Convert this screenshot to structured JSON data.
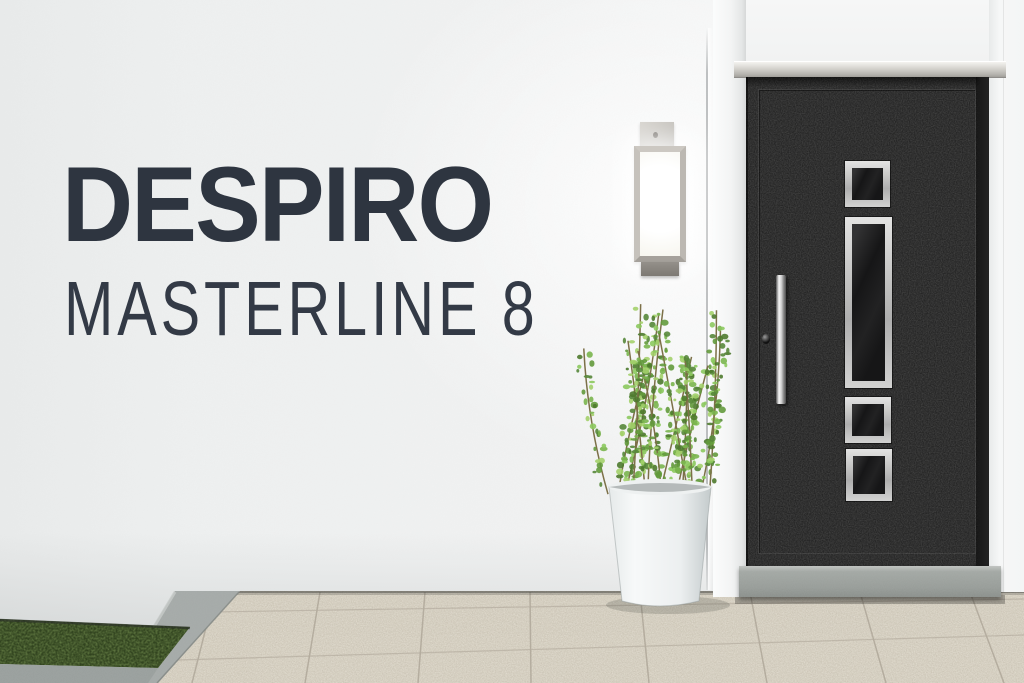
{
  "overlay": {
    "brand": "DESPIRO",
    "model": "MASTERLINE 8"
  },
  "colors": {
    "headline_text": "#2e3540",
    "wall": "#f1f2f2",
    "door": "#252525",
    "steel_trim": "#c6c6c5",
    "door_glass": "#161617",
    "threshold": "#9da29e",
    "floor_tile": "#d9d3c5",
    "tile_joint": "#b2ab9d",
    "grass": "#31431f",
    "curb": "#a6aba9",
    "planter_pot": "#f2f4f4",
    "plant_leaf": "#7ab54e",
    "lamp_metal": "#bcb8b2",
    "lamp_light": "#ffffff"
  }
}
